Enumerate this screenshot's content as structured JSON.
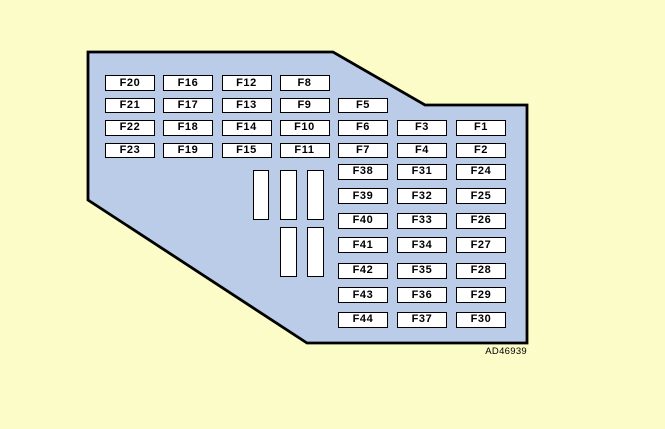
{
  "figure": {
    "code": "AD46939",
    "description": "Fuse box diagram"
  },
  "colors": {
    "background": "#FCFCC8",
    "panel_fill": "#BACCE8",
    "outline": "#000000",
    "slot_fill": "#FFFFFF"
  },
  "fuses": [
    {
      "id": "F20",
      "col": 0,
      "row": 0
    },
    {
      "id": "F16",
      "col": 1,
      "row": 0
    },
    {
      "id": "F12",
      "col": 2,
      "row": 0
    },
    {
      "id": "F8",
      "col": 3,
      "row": 0
    },
    {
      "id": "F21",
      "col": 0,
      "row": 1
    },
    {
      "id": "F17",
      "col": 1,
      "row": 1
    },
    {
      "id": "F13",
      "col": 2,
      "row": 1
    },
    {
      "id": "F9",
      "col": 3,
      "row": 1
    },
    {
      "id": "F5",
      "col": 4,
      "row": 1
    },
    {
      "id": "F22",
      "col": 0,
      "row": 2
    },
    {
      "id": "F18",
      "col": 1,
      "row": 2
    },
    {
      "id": "F14",
      "col": 2,
      "row": 2
    },
    {
      "id": "F10",
      "col": 3,
      "row": 2
    },
    {
      "id": "F6",
      "col": 4,
      "row": 2
    },
    {
      "id": "F3",
      "col": 5,
      "row": 2
    },
    {
      "id": "F1",
      "col": 6,
      "row": 2
    },
    {
      "id": "F23",
      "col": 0,
      "row": 3
    },
    {
      "id": "F19",
      "col": 1,
      "row": 3
    },
    {
      "id": "F15",
      "col": 2,
      "row": 3
    },
    {
      "id": "F11",
      "col": 3,
      "row": 3
    },
    {
      "id": "F7",
      "col": 4,
      "row": 3
    },
    {
      "id": "F4",
      "col": 5,
      "row": 3
    },
    {
      "id": "F2",
      "col": 6,
      "row": 3
    },
    {
      "id": "F38",
      "col": 4,
      "row": 4
    },
    {
      "id": "F31",
      "col": 5,
      "row": 4
    },
    {
      "id": "F24",
      "col": 6,
      "row": 4
    },
    {
      "id": "F39",
      "col": 4,
      "row": 5
    },
    {
      "id": "F32",
      "col": 5,
      "row": 5
    },
    {
      "id": "F25",
      "col": 6,
      "row": 5
    },
    {
      "id": "F40",
      "col": 4,
      "row": 6
    },
    {
      "id": "F33",
      "col": 5,
      "row": 6
    },
    {
      "id": "F26",
      "col": 6,
      "row": 6
    },
    {
      "id": "F41",
      "col": 4,
      "row": 7
    },
    {
      "id": "F34",
      "col": 5,
      "row": 7
    },
    {
      "id": "F27",
      "col": 6,
      "row": 7
    },
    {
      "id": "F42",
      "col": 4,
      "row": 8
    },
    {
      "id": "F35",
      "col": 5,
      "row": 8
    },
    {
      "id": "F28",
      "col": 6,
      "row": 8
    },
    {
      "id": "F43",
      "col": 4,
      "row": 9
    },
    {
      "id": "F36",
      "col": 5,
      "row": 9
    },
    {
      "id": "F29",
      "col": 6,
      "row": 9
    },
    {
      "id": "F44",
      "col": 4,
      "row": 10
    },
    {
      "id": "F37",
      "col": 5,
      "row": 10
    },
    {
      "id": "F30",
      "col": 6,
      "row": 10
    }
  ],
  "blank_slots": {
    "upper_count": 3,
    "lower_count": 2
  }
}
